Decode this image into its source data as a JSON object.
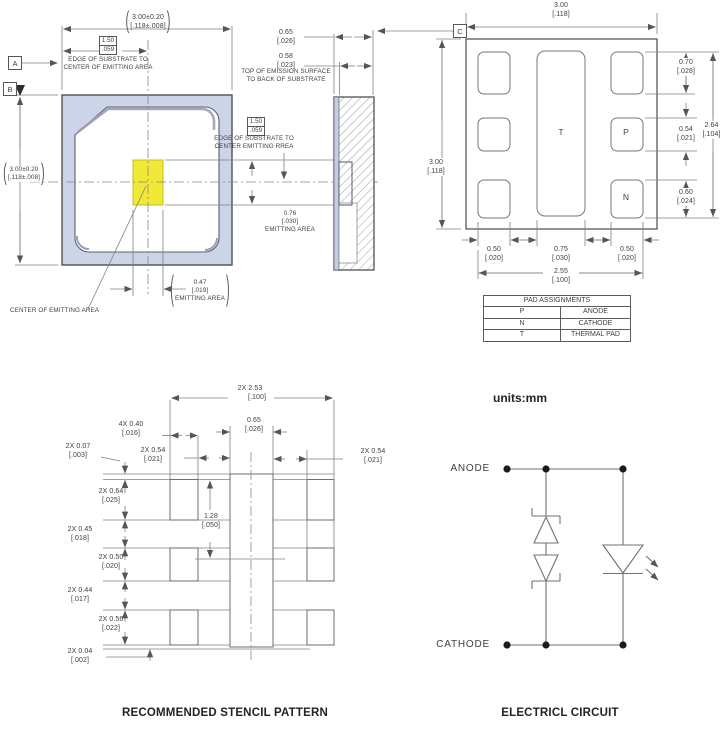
{
  "units_note": "units:mm",
  "captions": {
    "stencil": "RECOMMENDED STENCIL PATTERN",
    "circuit": "ELECTRICL CIRCUIT"
  },
  "datum": {
    "a": "A",
    "b": "B",
    "c": "C"
  },
  "top_view": {
    "width": {
      "l1": "3.00±0.20",
      "l2": "[.118±.008]"
    },
    "height": {
      "l1": "3.00±0.20",
      "l2": "[.118±.008]"
    },
    "edge_box": {
      "l1": "1.50",
      "l2": ".059"
    },
    "edge_note": {
      "l1": "EDGE OF SUBSTRATE TO",
      "l2": "CENTER OF EMITTING AREA"
    },
    "emit_w": {
      "l1": "0.47",
      "l2": "[.019]",
      "l3": "EMITTING AREA"
    },
    "center_note": "CENTER OF EMITTING AREA"
  },
  "side_view": {
    "thickness": {
      "l1": "0.65",
      "l2": "[.026]"
    },
    "emission": {
      "l1": "0.58",
      "l2": "[.023]"
    },
    "emission_note": {
      "l1": "TOP OF EMISSION SURFACE",
      "l2": "TO BACK OF SUBSTRATE"
    },
    "edge_box": {
      "l1": "1.50",
      "l2": ".059"
    },
    "edge_note": {
      "l1": "EDGE OF SUBSTRATE TO",
      "l2": "CENTER EMITTING RREA"
    },
    "emit_h": {
      "l1": "0.76",
      "l2": "[.030]",
      "l3": "EMITTING AREA"
    }
  },
  "bottom_view": {
    "width": {
      "l1": "3.00",
      "l2": "[.118]"
    },
    "height": {
      "l1": "3.00",
      "l2": "[.118]"
    },
    "pad_top_h": {
      "l1": "0.70",
      "l2": "[.028]"
    },
    "pad_span_v": {
      "l1": "2.64",
      "l2": "[.104]"
    },
    "pad_mid_h": {
      "l1": "0.54",
      "l2": "[.021]"
    },
    "pad_bot_h": {
      "l1": "0.60",
      "l2": "[.024]"
    },
    "pad_left_w": {
      "l1": "0.50",
      "l2": "[.020]"
    },
    "pad_center_w": {
      "l1": "0.75",
      "l2": "[.030]"
    },
    "pad_right_w": {
      "l1": "0.50",
      "l2": "[.020]"
    },
    "pad_span_h": {
      "l1": "2.55",
      "l2": "[.100]"
    },
    "pad_labels": {
      "t": "T",
      "p": "P",
      "n": "N"
    }
  },
  "pad_table": {
    "title": "PAD ASSIGNMENTS",
    "rows": [
      {
        "pad": "P",
        "assignment": "ANODE"
      },
      {
        "pad": "N",
        "assignment": "CATHODE"
      },
      {
        "pad": "T",
        "assignment": "THERMAL PAD"
      }
    ]
  },
  "stencil": {
    "overall": {
      "l1": "2X 2.53",
      "l2": "[.100]"
    },
    "center_w": {
      "l1": "0.65",
      "l2": "[.026]"
    },
    "aperture_w": {
      "l1": "4X 0.40",
      "l2": "[.016]"
    },
    "gap_left": {
      "l1": "2X 0.54",
      "l2": "[.021]"
    },
    "gap_right": {
      "l1": "2X 0.54",
      "l2": "[.021]"
    },
    "offset_top": {
      "l1": "2X 0.07",
      "l2": "[.003]"
    },
    "row1_h": {
      "l1": "2X 0.64",
      "l2": "[.025]"
    },
    "gap1_v": {
      "l1": "2X 0.45",
      "l2": "[.018]"
    },
    "row2_h": {
      "l1": "2X 0.50",
      "l2": "[.020]"
    },
    "gap2_v": {
      "l1": "2X 0.44",
      "l2": "[.017]"
    },
    "row3_h": {
      "l1": "2X 0.56",
      "l2": "[.022]"
    },
    "offset_bottom": {
      "l1": "2X 0.04",
      "l2": "[.002]"
    },
    "center_pitch": {
      "l1": "1.28",
      "l2": "[.050]"
    }
  },
  "circuit": {
    "anode": "ANODE",
    "cathode": "CATHODE"
  },
  "colors": {
    "substrate_fill": "#ccd4e8",
    "emitting_area": "#f2e936",
    "geometry_line": "#54565b",
    "dimension_line": "#7e8187",
    "text": "#3e3f42"
  }
}
